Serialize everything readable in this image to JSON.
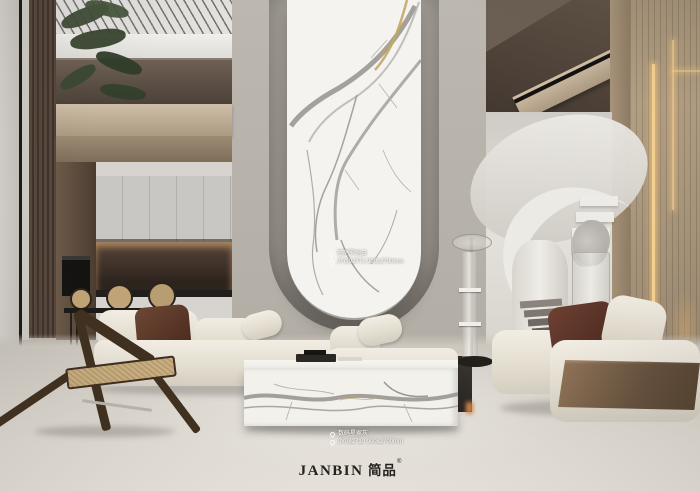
{
  "slabs": {
    "top": {
      "name": "巴萨罗纳白",
      "code": "JYG92771 900x2700mm"
    },
    "bottom": {
      "name": "数码星家灰",
      "code": "JY082710 900x2700mm"
    }
  },
  "watermark": {
    "brand_latin": "JANBIN",
    "brand_cjk": "简品",
    "reg": "®"
  },
  "palette": {
    "marble_white": "#f5f3ef",
    "wall_gray": "#b6b1a9",
    "wood_warm": "#b4a084",
    "led_gold": "#f5cd8a",
    "floor": "#ddd8d0",
    "brand_text": "#23211e"
  }
}
